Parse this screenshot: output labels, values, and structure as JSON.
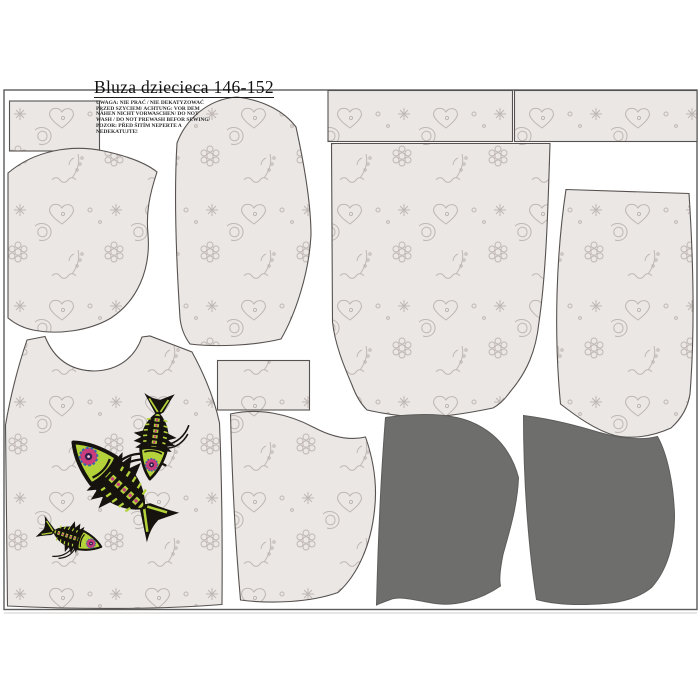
{
  "header": {
    "title": "Bluza dziecieca 146-152",
    "care_lines": [
      "UWAGA: NIE PRAĆ / NIE DEKATYZOWAĆ",
      "PRZED SZYCIEM/ ACHTUNG: VOR DEM",
      "NÄHEN NICHT VORWASCHEN/ DO NOT",
      "WASH / DO NOT PREWASH BEFOR SEWING/",
      "POZOR: PŘED ŠITÍM NEPERTE A",
      "NEDEKATUJTE!"
    ]
  },
  "pieces": [
    {
      "id": "small-rect-top-left",
      "fill": "printed"
    },
    {
      "id": "neck-facing-curved",
      "fill": "printed"
    },
    {
      "id": "sleeve-left",
      "fill": "printed"
    },
    {
      "id": "waistband-strip-1",
      "fill": "printed"
    },
    {
      "id": "waistband-strip-2",
      "fill": "printed"
    },
    {
      "id": "back-bodice",
      "fill": "printed"
    },
    {
      "id": "sleeve-right",
      "fill": "printed"
    },
    {
      "id": "front-bodice-with-fish-motif",
      "fill": "printed"
    },
    {
      "id": "small-rect-middle",
      "fill": "printed"
    },
    {
      "id": "hood-side-printed",
      "fill": "printed"
    },
    {
      "id": "hood-side-gray-1",
      "fill": "solid-gray"
    },
    {
      "id": "hood-side-gray-2",
      "fill": "solid-gray"
    }
  ],
  "motif": {
    "description": "three fish skeletons with flower eyes",
    "count": 3
  },
  "colors": {
    "background": "#ffffff",
    "fabric_base": "#eae7e5",
    "fabric_motif": "#bdb4b0",
    "piece_outline": "#57524f",
    "frame": "#5b5b5b",
    "solid_piece_gray": "#6e6e6c",
    "fish_black": "#16130f",
    "fish_green": "#b4d23a",
    "fish_pink": "#c93d7c",
    "fish_blue": "#3a68ad"
  }
}
